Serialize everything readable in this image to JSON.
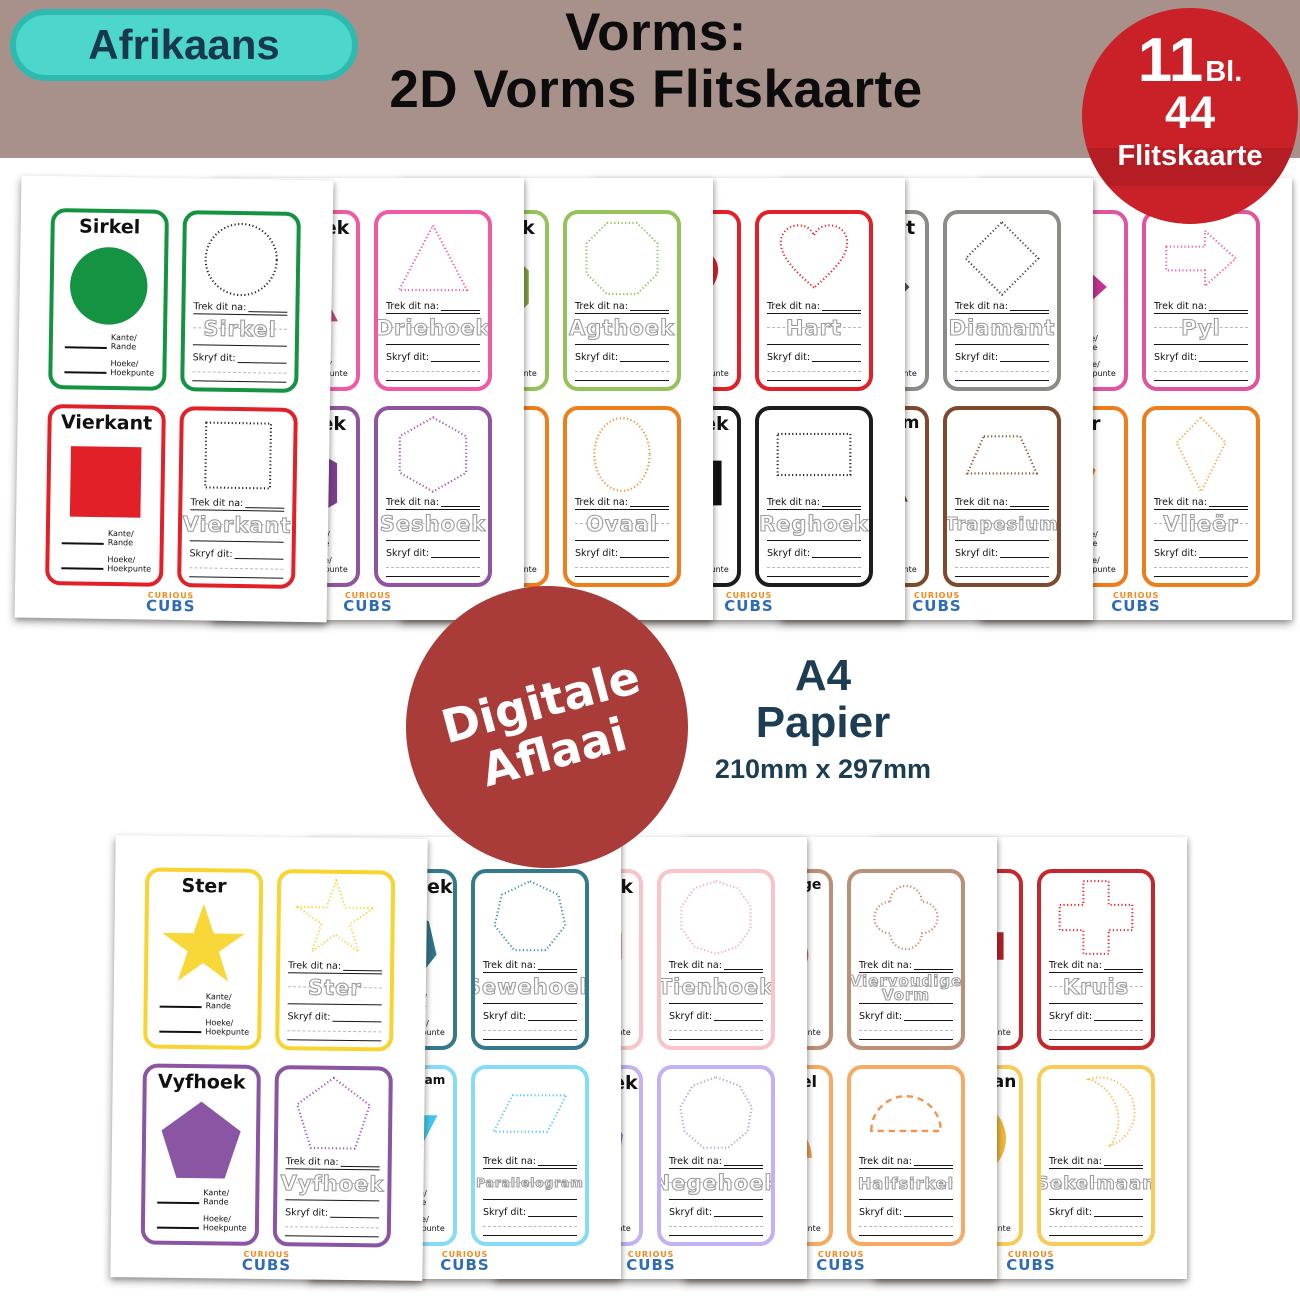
{
  "header": {
    "language_badge": "Afrikaans",
    "title_line1": "Vorms:",
    "title_line2": "2D Vorms Flitskaarte",
    "count_badge": {
      "pages_count": "11",
      "pages_unit": "Bl.",
      "cards_count": "44",
      "cards_label": "Flitskaarte"
    },
    "colors": {
      "band": "#a8918a",
      "badge_bg": "#4dd7cc",
      "badge_border": "#2fbab0",
      "badge_text": "#17384d",
      "count_badge_bg": "#c92127"
    }
  },
  "middle": {
    "download_badge": {
      "line1": "Digitale",
      "line2": "Aflaai",
      "bg": "#a93b38"
    },
    "paper": {
      "size_name": "A4",
      "material": "Papier",
      "dimensions": "210mm x 297mm",
      "text_color": "#1d3d52"
    }
  },
  "card_labels": {
    "trace_prompt": "Trek dit na:",
    "write_prompt": "Skryf dit:",
    "sides": [
      "Kante/",
      "Rande"
    ],
    "corners": [
      "Hoeke/",
      "Hoekpunte"
    ]
  },
  "logo": {
    "top": "CURIOUS",
    "bottom": "CUBS",
    "top_color": "#f28a1e",
    "bottom_color": "#2e6cb6"
  },
  "top_pages": [
    {
      "shapes": [
        {
          "name": "Sirkel",
          "shape": "circle",
          "color": "#149343",
          "dot": "#222222",
          "fill": "#149343"
        },
        {
          "name": "Vierkant",
          "shape": "square",
          "color": "#e22028",
          "dot": "#222222",
          "fill": "#e22028"
        }
      ]
    },
    {
      "shapes": [
        {
          "name": "Driehoek",
          "shape": "triangle",
          "color": "#ee5aa3",
          "dot": "#f351a5",
          "fill": "#c4447c"
        },
        {
          "name": "Seshoek",
          "shape": "hexagon",
          "color": "#9253a2",
          "dot": "#9b50b5",
          "fill": "#7c3f90"
        }
      ]
    },
    {
      "shapes": [
        {
          "name": "Agthoek",
          "shape": "octagon",
          "color": "#96c25b",
          "dot": "#8fbf4f",
          "fill": "#7da33f"
        },
        {
          "name": "Ovaal",
          "shape": "oval",
          "color": "#ee7d1b",
          "dot": "#f68c2a",
          "fill": "#e97613"
        }
      ]
    },
    {
      "shapes": [
        {
          "name": "Hart",
          "shape": "heart",
          "color": "#e22028",
          "dot": "#ee1c24",
          "fill": "#d41f24"
        },
        {
          "name": "Reghoek",
          "shape": "rectangle",
          "color": "#1c1c1c",
          "dot": "#222222",
          "fill": "#111111"
        }
      ]
    },
    {
      "shapes": [
        {
          "name": "Diamant",
          "shape": "diamond",
          "color": "#8b8b87",
          "dot": "#454545",
          "fill": "#4f4f4f"
        },
        {
          "name": "Trapesium",
          "shape": "trapezium",
          "color": "#7d4b2c",
          "dot": "#8c4e21",
          "fill": "#74452a"
        }
      ]
    },
    {
      "shapes": [
        {
          "name": "Pyl",
          "shape": "arrow",
          "color": "#df549f",
          "dot": "#f84fa8",
          "fill": "#bf3490"
        },
        {
          "name": "Vlieër",
          "shape": "kite",
          "color": "#ee7d1b",
          "dot": "#f6a53f",
          "fill": "#ee7d1b"
        }
      ]
    }
  ],
  "bottom_pages": [
    {
      "shapes": [
        {
          "name": "Ster",
          "shape": "star",
          "color": "#f7d42f",
          "dot": "#f7d42f",
          "fill": "#f7d838"
        },
        {
          "name": "Vyfhoek",
          "shape": "pentagon",
          "color": "#8a55a2",
          "dot": "#9b50b5",
          "fill": "#8a55a2"
        }
      ]
    },
    {
      "shapes": [
        {
          "name": "Sewehoek",
          "shape": "heptagon",
          "color": "#35798d",
          "dot": "#3f8fa8",
          "fill": "#2f7488"
        },
        {
          "name": "Parallelogram",
          "shape": "parallelogram",
          "color": "#86dcf5",
          "dot": "#4fcbf0",
          "fill": "#41c7ee"
        }
      ]
    },
    {
      "shapes": [
        {
          "name": "Tienhoek",
          "shape": "decagon",
          "color": "#f8c3c9",
          "dot": "#f5aab4",
          "fill": "#dd6472"
        },
        {
          "name": "Negehoek",
          "shape": "nonagon",
          "color": "#c4b0f2",
          "dot": "#b29bee",
          "fill": "#8b76d2"
        }
      ]
    },
    {
      "shapes": [
        {
          "name": "Viervoudige Vorm",
          "shape": "quatrefoil",
          "color": "#bc8f77",
          "dot": "#c9805d",
          "fill": "#aa775e"
        },
        {
          "name": "Halfsirkel",
          "shape": "semicircle",
          "color": "#f6aa64",
          "dot": "#f4914a",
          "fill": "#f19a51",
          "dash": "long"
        }
      ]
    },
    {
      "shapes": [
        {
          "name": "Kruis",
          "shape": "cross",
          "color": "#c4282c",
          "dot": "#ea1c24",
          "fill": "#b42025"
        },
        {
          "name": "Sekelmaan",
          "shape": "crescent",
          "color": "#f8cb58",
          "dot": "#f8bc41",
          "fill": "#eeb83b"
        }
      ]
    }
  ]
}
